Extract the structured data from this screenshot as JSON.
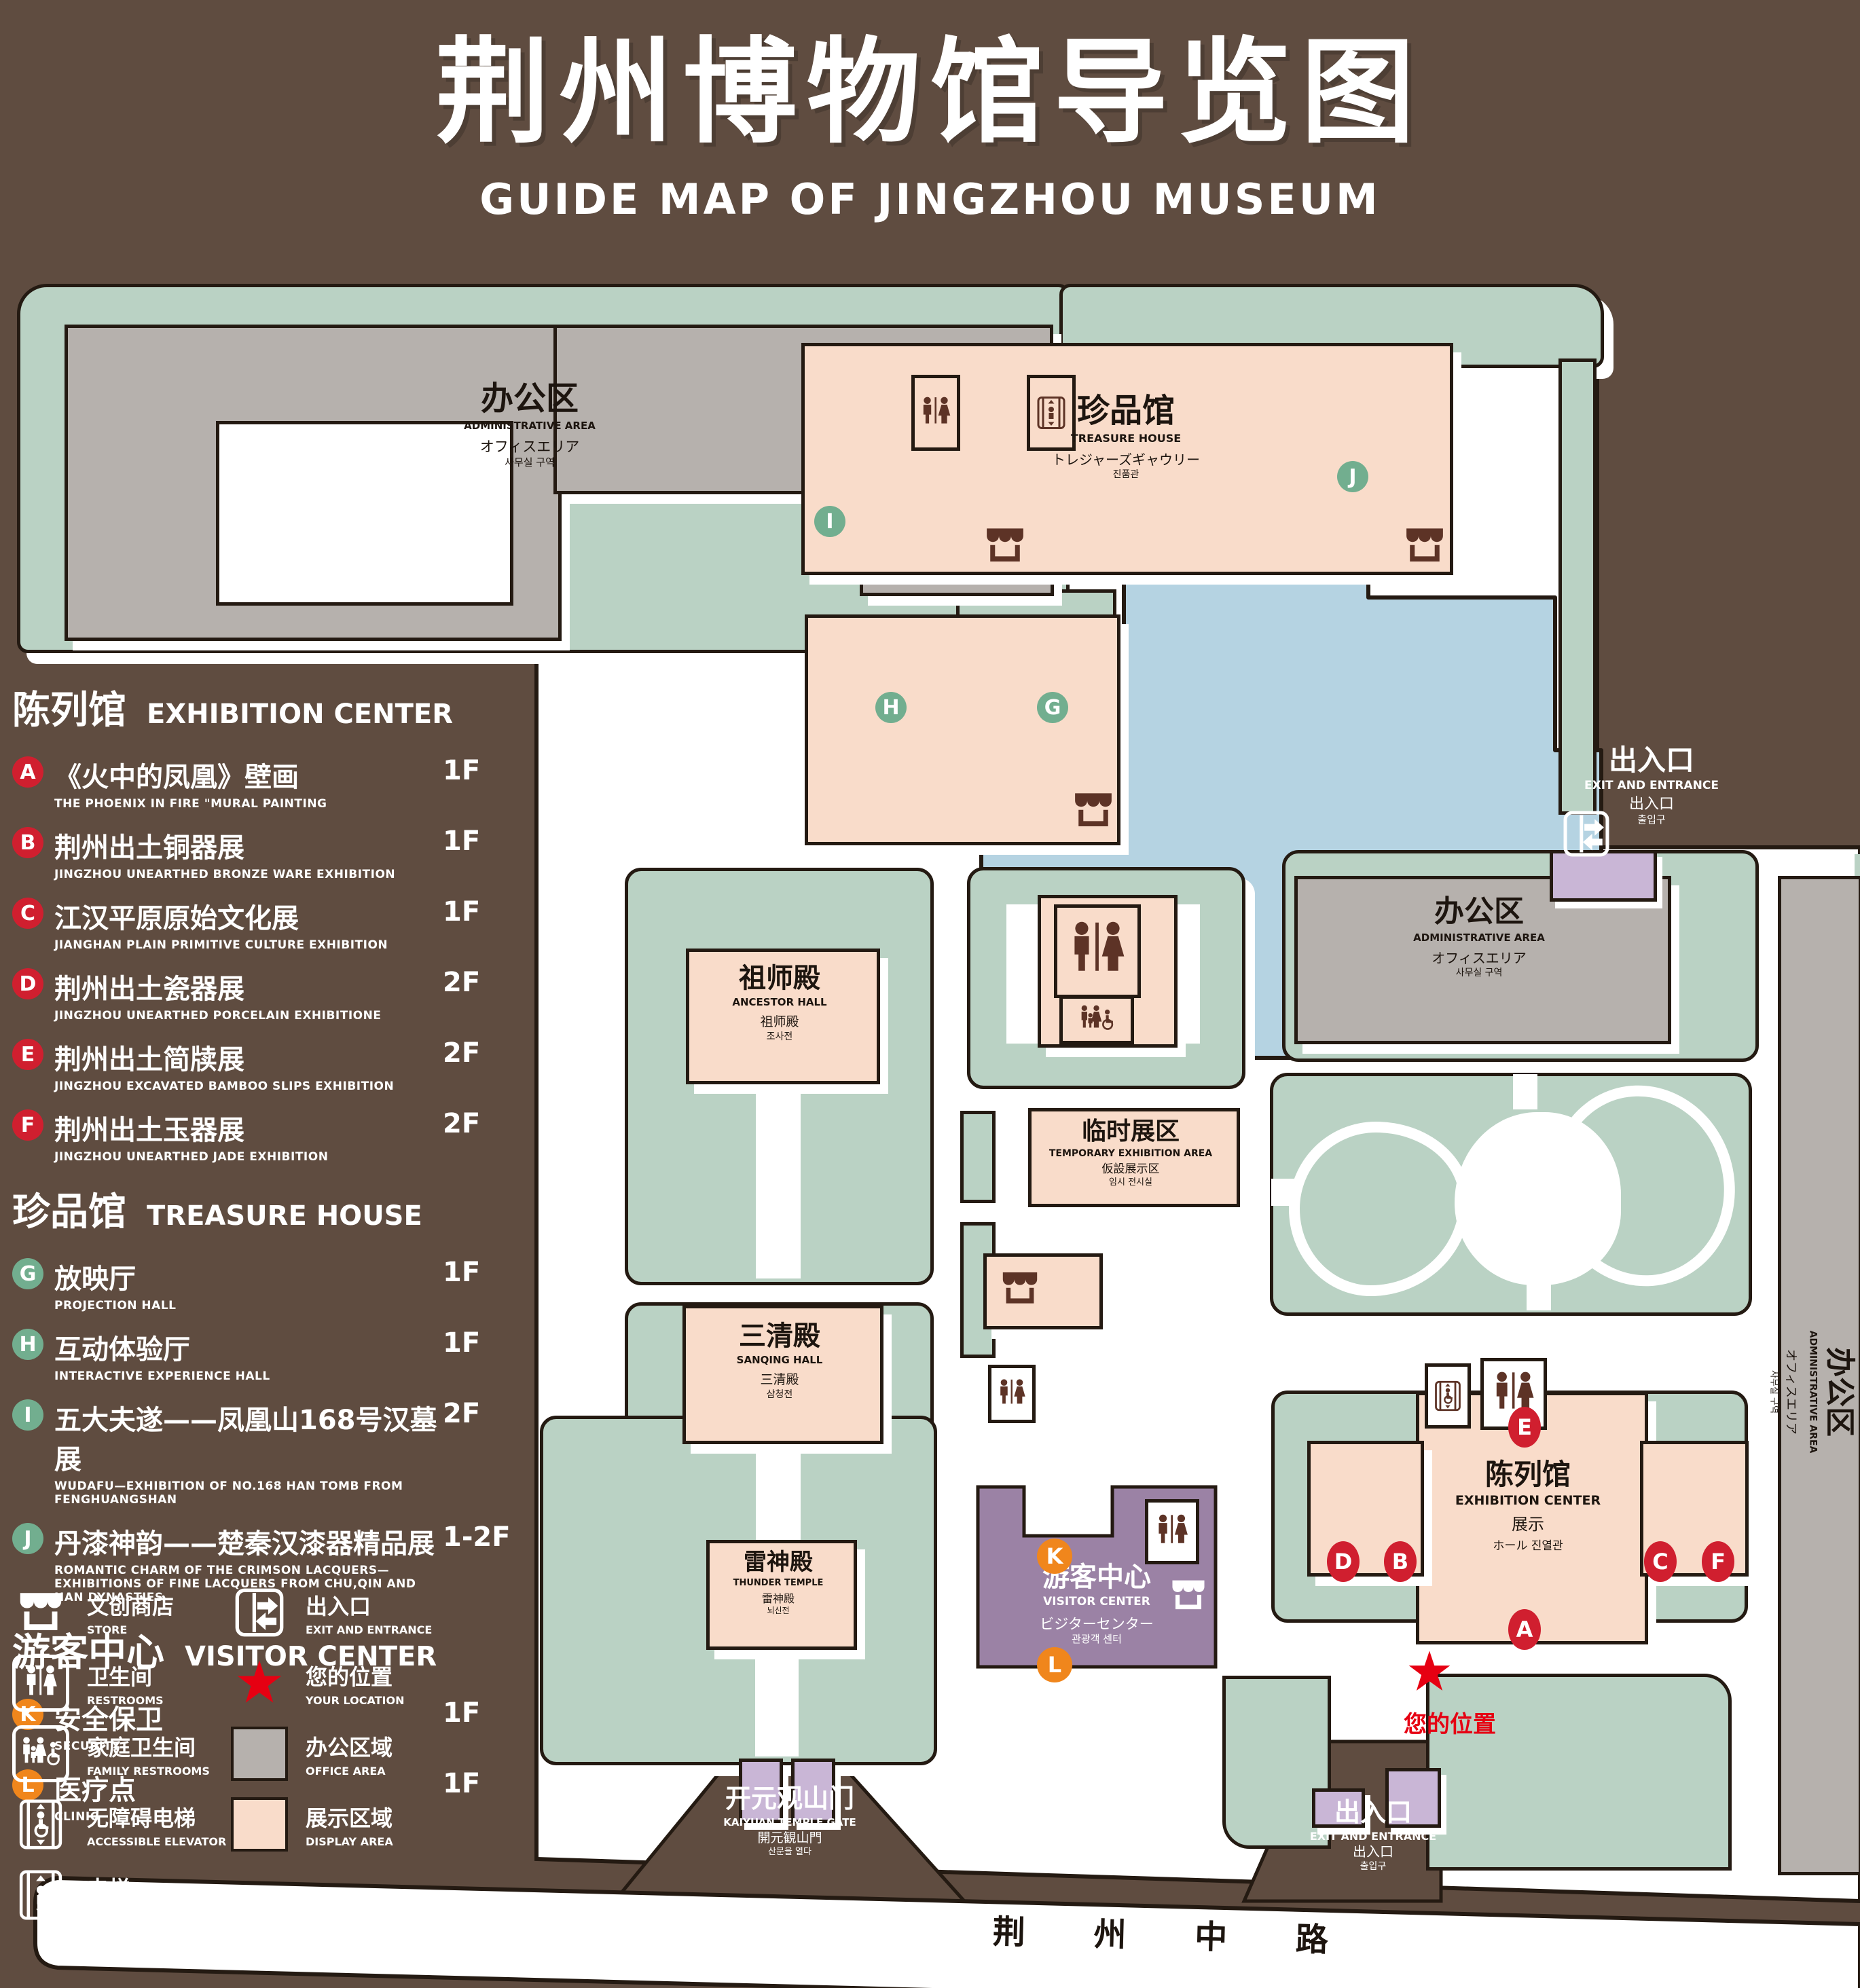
{
  "title": {
    "zh": "荆州博物馆导览图",
    "en": "GUIDE MAP OF JINGZHOU MUSEUM"
  },
  "legend": {
    "sections": [
      {
        "title_zh": "陈列馆",
        "title_en": "EXHIBITION CENTER",
        "items": [
          {
            "id": "A",
            "zh": "《火中的凤凰》壁画",
            "en": "THE PHOENIX IN FIRE \"MURAL PAINTING",
            "floor": "1F"
          },
          {
            "id": "B",
            "zh": "荆州出土铜器展",
            "en": "JINGZHOU UNEARTHED BRONZE WARE EXHIBITION",
            "floor": "1F"
          },
          {
            "id": "C",
            "zh": "江汉平原原始文化展",
            "en": "JIANGHAN PLAIN PRIMITIVE CULTURE EXHIBITION",
            "floor": "1F"
          },
          {
            "id": "D",
            "zh": "荆州出土瓷器展",
            "en": "JINGZHOU UNEARTHED PORCELAIN EXHIBITIONE",
            "floor": "2F"
          },
          {
            "id": "E",
            "zh": "荆州出土简牍展",
            "en": "JINGZHOU EXCAVATED BAMBOO SLIPS EXHIBITION",
            "floor": "2F"
          },
          {
            "id": "F",
            "zh": "荆州出土玉器展",
            "en": "JINGZHOU UNEARTHED JADE EXHIBITION",
            "floor": "2F"
          }
        ]
      },
      {
        "title_zh": "珍品馆",
        "title_en": "TREASURE HOUSE",
        "items": [
          {
            "id": "G",
            "zh": "放映厅",
            "en": "PROJECTION HALL",
            "floor": "1F"
          },
          {
            "id": "H",
            "zh": "互动体验厅",
            "en": "INTERACTIVE EXPERIENCE HALL",
            "floor": "1F"
          },
          {
            "id": "I",
            "zh": "五大夫遂——凤凰山168号汉墓展",
            "en": "WUDAFU—EXHIBITION OF NO.168 HAN TOMB FROM FENGHUANGSHAN",
            "floor": "2F"
          },
          {
            "id": "J",
            "zh": "丹漆神韵——楚秦汉漆器精品展",
            "en": "ROMANTIC CHARM OF THE CRIMSON LACQUERS—EXHIBITIONS OF FINE LACQUERS FROM CHU,QIN AND HAN DYNASTIES",
            "floor": "1-2F"
          }
        ]
      },
      {
        "title_zh": "游客中心",
        "title_en": "VISITOR CENTER",
        "items": [
          {
            "id": "K",
            "zh": "安全保卫",
            "en": "SECURITY",
            "floor": "1F"
          },
          {
            "id": "L",
            "zh": "医疗点",
            "en": "CLINIC",
            "floor": "1F"
          }
        ]
      }
    ],
    "symbols": {
      "store": {
        "zh": "文创商店",
        "en": "STORE"
      },
      "restrooms": {
        "zh": "卫生间",
        "en": "RESTROOMS"
      },
      "family_restrooms": {
        "zh": "家庭卫生间",
        "en": "FAMILY RESTROOMS"
      },
      "accessible_elevator": {
        "zh": "无障碍电梯",
        "en": "ACCESSIBLE ELEVATOR"
      },
      "elevator": {
        "zh": "电梯",
        "en": "Elevator"
      },
      "exit": {
        "zh": "出入口",
        "en": "EXIT AND ENTRANCE"
      },
      "location": {
        "zh": "您的位置",
        "en": "YOUR LOCATION"
      },
      "office": {
        "zh": "办公区域",
        "en": "OFFICE AREA"
      },
      "display": {
        "zh": "展示区域",
        "en": "DISPLAY AREA"
      }
    }
  },
  "map": {
    "admin": {
      "zh": "办公区",
      "en": "ADMINISTRATIVE AREA",
      "ja": "オフィスエリア",
      "ko": "사무실 구역"
    },
    "treasure_house": {
      "zh": "珍品馆",
      "en": "TREASURE HOUSE",
      "ja": "トレジャーズギャウリー",
      "ko": "진품관"
    },
    "ancestor_hall": {
      "zh": "祖师殿",
      "en": "ANCESTOR HALL",
      "zh2": "祖师殿",
      "ko": "조사전"
    },
    "sanqing_hall": {
      "zh": "三清殿",
      "en": "SANQING HALL",
      "zh2": "三清殿",
      "ko": "삼청전"
    },
    "temporary": {
      "zh": "临时展区",
      "en": "TEMPORARY EXHIBITION AREA",
      "ja": "仮設展示区",
      "ko": "임시 전시실"
    },
    "thunder_temple": {
      "zh": "雷神殿",
      "en": "THUNDER TEMPLE",
      "zh2": "雷神殿",
      "ko": "뇌신전"
    },
    "visitor_center": {
      "zh": "游客中心",
      "en": "VISITOR CENTER",
      "ja": "ビジターセンター",
      "ko": "관광객 센터"
    },
    "exhibition_center": {
      "zh": "陈列馆",
      "en": "EXHIBITION CENTER",
      "zh2": "展示",
      "jako": "ホール 진열관"
    },
    "gate": {
      "zh": "开元观山门",
      "en": "KAIYUAN TEMPLE GATE",
      "ja": "開元観山門",
      "ko": "산문을 열다"
    },
    "exit": {
      "zh": "出入口",
      "en": "EXIT AND ENTRANCE",
      "zh2": "出入口",
      "ko": "출입구"
    },
    "your_location": "您的位置",
    "road": "荆 州 中 路",
    "marker_letters": {
      "A": "A",
      "B": "B",
      "C": "C",
      "D": "D",
      "E": "E",
      "F": "F",
      "G": "G",
      "H": "H",
      "I": "I",
      "J": "J",
      "K": "K",
      "L": "L"
    }
  },
  "colors": {
    "background": "#5f4c40",
    "ground": "#ffffff",
    "landscape_green": "#bad2c4",
    "display_area_pink": "#f9dcca",
    "office_gray": "#b6b1ad",
    "lake_blue": "#b5d3e2",
    "visitor_purple": "#9b82a5",
    "gate_purple": "#c9b6d6",
    "badge_red": "#d01f2f",
    "badge_green": "#72ae8f",
    "badge_orange": "#f0861c",
    "icon_maroon": "#5d3326",
    "location_red": "#e60012",
    "outline": "#241a12"
  }
}
